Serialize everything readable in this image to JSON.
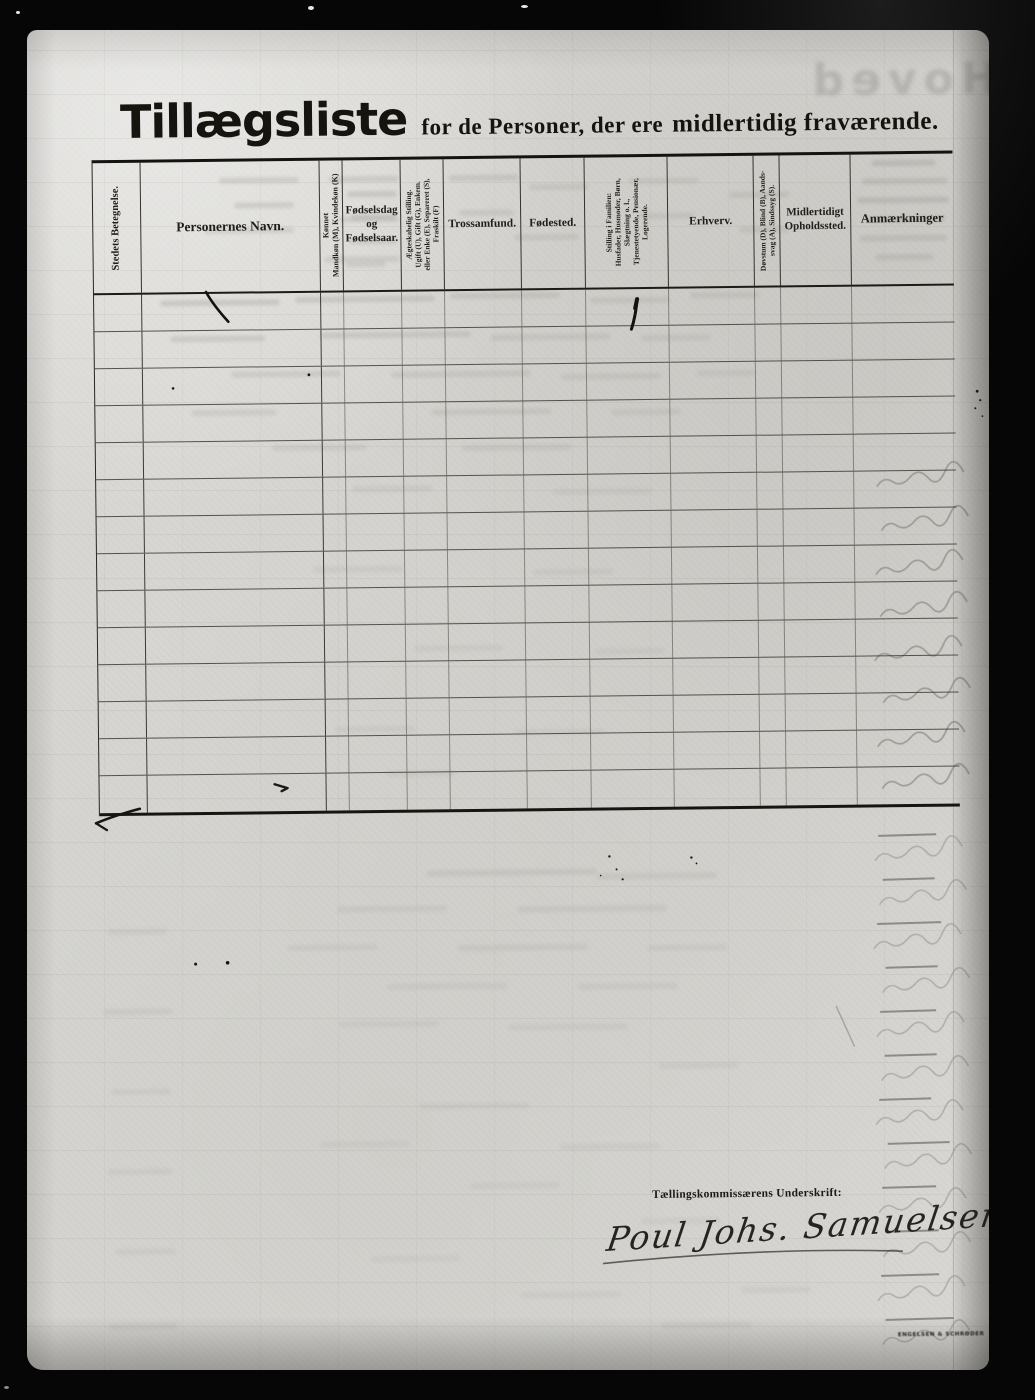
{
  "document": {
    "title": {
      "main": "Tillægsliste",
      "subtitle_regular": "for de Personer, der ere",
      "subtitle_bold": "midlertidig fraværende."
    },
    "watermark_ghost": "Hoved",
    "signature": {
      "label": "Tællingskommissærens Underskrift:",
      "name": "Poul Johs. Samuelsen"
    },
    "printer_mark": "ENGELSEN & SCHRØDER"
  },
  "table": {
    "row_count": 14,
    "columns": [
      {
        "key": "sted",
        "label": "Stedets Betegnelse.",
        "rotated": true,
        "width": 48,
        "font": 10.5
      },
      {
        "key": "navn",
        "label": "Personernes Navn.",
        "rotated": false,
        "width": 179,
        "font": 13.5
      },
      {
        "key": "kjonnet",
        "label": "Kønnet\nMandkøn (M), Kvindekøn (K)",
        "rotated": true,
        "width": 23,
        "font": 8
      },
      {
        "key": "fodsel",
        "label": "Fødselsdag\nog\nFødselsaar.",
        "rotated": false,
        "width": 58,
        "font": 11
      },
      {
        "key": "aegteskab",
        "label": "Ægteskabelig Stilling.\nUgift (U), Gift (G), Enkem.\neller Enke (E), Separeret (S),\nFraskilt (F)",
        "rotated": true,
        "width": 43,
        "font": 7.5
      },
      {
        "key": "trossamfund",
        "label": "Trossamfund.",
        "rotated": false,
        "width": 77,
        "font": 11.5
      },
      {
        "key": "fodested",
        "label": "Fødested.",
        "rotated": false,
        "width": 64,
        "font": 11.5
      },
      {
        "key": "stilling",
        "label": "Stilling i Familien:\nHusfader, Husmoder, Børn,\nSlægtning o. l.,\nTjenestetyende, Pensionær,\nLogerende.",
        "rotated": true,
        "width": 83,
        "font": 7.5
      },
      {
        "key": "erhverv",
        "label": "Erhverv.",
        "rotated": false,
        "width": 86,
        "font": 11.5
      },
      {
        "key": "dovstum",
        "label": "Døvstum (D), Blind (B), Aands-\nsvag (A), Sindssyg (S).",
        "rotated": true,
        "width": 26,
        "font": 7.5
      },
      {
        "key": "ophold",
        "label": "Midlertidigt\nOpholdssted.",
        "rotated": false,
        "width": 71,
        "font": 11
      },
      {
        "key": "anmaerkninger",
        "label": "Anmærkninger",
        "rotated": false,
        "width": 102,
        "font": 12.5
      }
    ]
  }
}
